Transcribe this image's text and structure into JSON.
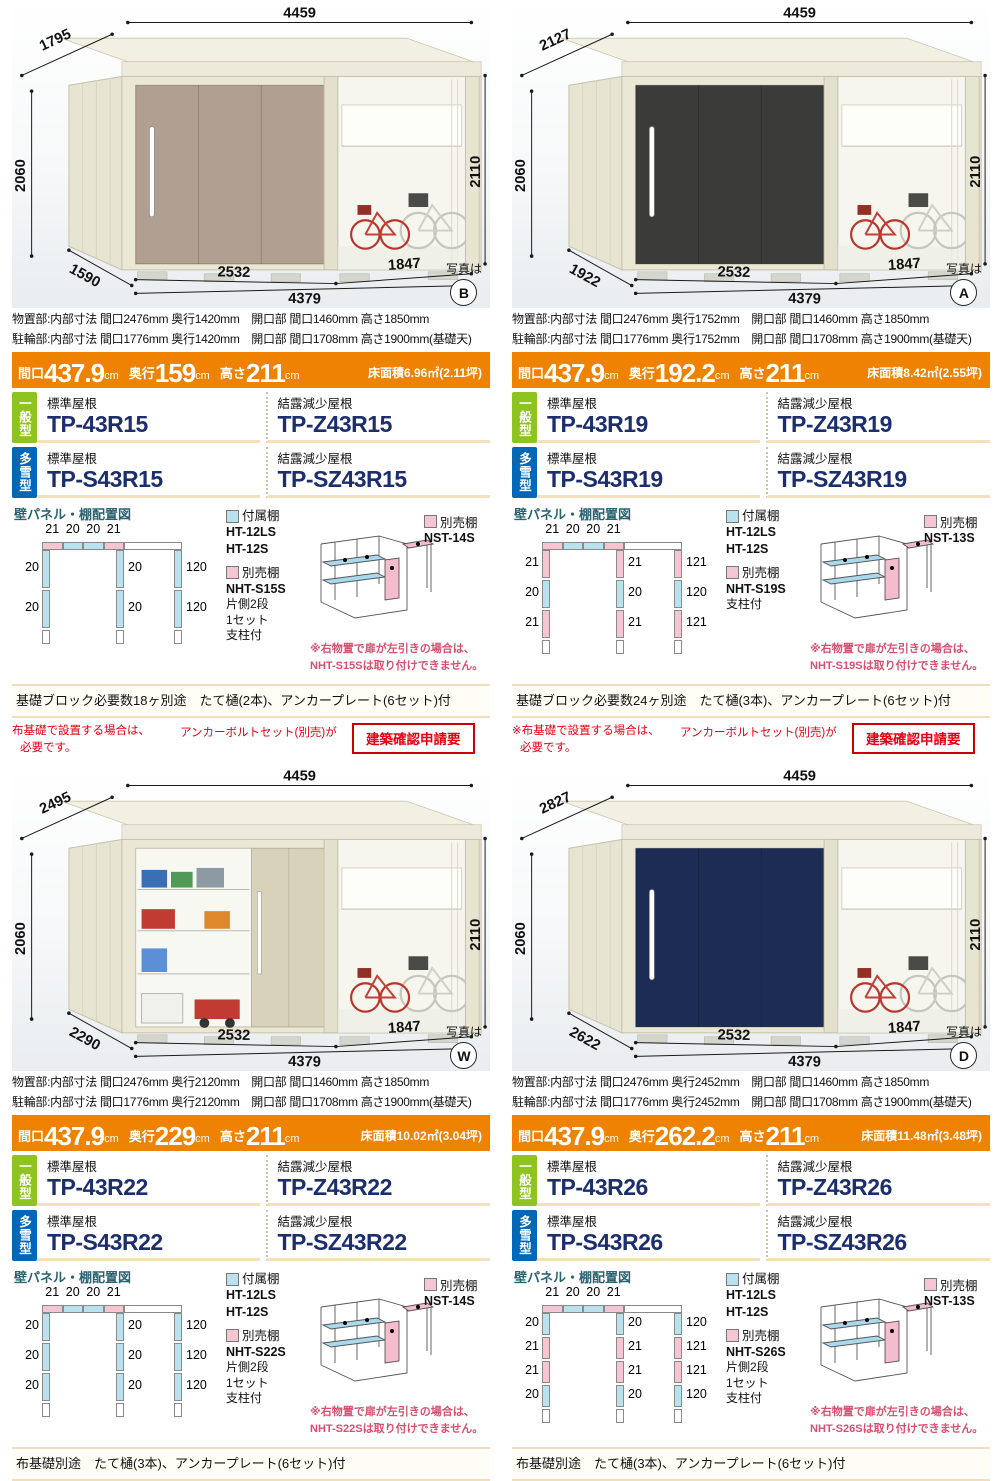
{
  "common": {
    "photo_label": "写真は",
    "panel_title": "壁パネル・棚配置図",
    "attached_label": "付属棚",
    "attached_models": [
      "HT-12LS",
      "HT-12S"
    ],
    "optional_label": "別売棚",
    "roof_standard": "標準屋根",
    "roof_dew": "結露減少屋根",
    "badge_general": "一般型",
    "badge_snow": "多雪型",
    "banner_labels": {
      "maguchi": "間口",
      "okuyuki": "奥行",
      "takasa": "高さ",
      "unit": "cm"
    },
    "panel_colors": {
      "blue": "#b9e1ee",
      "pink": "#f6c5d2"
    },
    "accent_orange": "#ef8200",
    "badge_green_color": "#8fc31f",
    "badge_blue_color": "#0068b7",
    "model_number_color": "#1c2e6e"
  },
  "products": [
    {
      "photo_letter": "B",
      "door_color": "#b1a091",
      "open": false,
      "notice": null,
      "dims": {
        "top_depth": "1795",
        "width": "4459",
        "left_h": "2060",
        "right_h": "2110",
        "storage_w": "2532",
        "bike_w": "1847",
        "total_w": "4379",
        "bottom_depth": "1590"
      },
      "specs": [
        "物置部:内部寸法 間口2476mm 奥行1420mm　開口部 間口1460mm 高さ1850mm",
        "駐輪部:内部寸法 間口1776mm 奥行1420mm　開口部 間口1708mm 高さ1900mm(基礎天)"
      ],
      "banner": {
        "maguchi": "437.9",
        "okuyuki": "159",
        "takasa": "211",
        "floor": "床面積6.96㎡(2.11坪)"
      },
      "models": {
        "g_std": "TP-43R15",
        "g_dew": "TP-Z43R15",
        "s_std": "TP-S43R15",
        "s_dew": "TP-SZ43R15"
      },
      "panel": {
        "top": [
          "21",
          "20",
          "20",
          "21"
        ],
        "left": [
          "20",
          "20"
        ],
        "mid": [
          "20",
          "20"
        ],
        "right": [
          "120",
          "120"
        ]
      },
      "optional1": "NST-14S",
      "optional2": [
        "NHT-S15S",
        "片側2段",
        "1セット",
        "支柱付"
      ],
      "warning": [
        "※右物置で扉が左引きの場合は、",
        "NHT-S15Sは取り付けできません。"
      ],
      "foundation": "基礎ブロック必要数18ヶ別途　たて樋(2本)、アンカープレート(6セット)付"
    },
    {
      "photo_letter": "A",
      "door_color": "#3b3b39",
      "open": false,
      "notice": null,
      "dims": {
        "top_depth": "2127",
        "width": "4459",
        "left_h": "2060",
        "right_h": "2110",
        "storage_w": "2532",
        "bike_w": "1847",
        "total_w": "4379",
        "bottom_depth": "1922"
      },
      "specs": [
        "物置部:内部寸法 間口2476mm 奥行1752mm　開口部 間口1460mm 高さ1850mm",
        "駐輪部:内部寸法 間口1776mm 奥行1752mm　開口部 間口1708mm 高さ1900mm(基礎天)"
      ],
      "banner": {
        "maguchi": "437.9",
        "okuyuki": "192.2",
        "takasa": "211",
        "floor": "床面積8.42㎡(2.55坪)"
      },
      "models": {
        "g_std": "TP-43R19",
        "g_dew": "TP-Z43R19",
        "s_std": "TP-S43R19",
        "s_dew": "TP-SZ43R19"
      },
      "panel": {
        "top": [
          "21",
          "20",
          "20",
          "21"
        ],
        "left": [
          "21",
          "20",
          "21"
        ],
        "mid": [
          "21",
          "20",
          "21"
        ],
        "right": [
          "121",
          "120",
          "121"
        ]
      },
      "optional1": "NST-13S",
      "optional2": [
        "NHT-S19S",
        "支柱付"
      ],
      "warning": [
        "※右物置で扉が左引きの場合は、",
        "NHT-S19Sは取り付けできません。"
      ],
      "foundation": "基礎ブロック必要数24ヶ別途　たて樋(3本)、アンカープレート(6セット)付"
    },
    {
      "photo_letter": "W",
      "door_color": "#d9d2ba",
      "open": true,
      "notice": {
        "line1": "布基礎で設置する場合は、",
        "line2": "必要です。",
        "mid": "アンカーボルトセット(別売)が",
        "boxed": "建築確認申請要"
      },
      "dims": {
        "top_depth": "2495",
        "width": "4459",
        "left_h": "2060",
        "right_h": "2110",
        "storage_w": "2532",
        "bike_w": "1847",
        "total_w": "4379",
        "bottom_depth": "2290"
      },
      "specs": [
        "物置部:内部寸法 間口2476mm 奥行2120mm　開口部 間口1460mm 高さ1850mm",
        "駐輪部:内部寸法 間口1776mm 奥行2120mm　開口部 間口1708mm 高さ1900mm(基礎天)"
      ],
      "banner": {
        "maguchi": "437.9",
        "okuyuki": "229",
        "takasa": "211",
        "floor": "床面積10.02㎡(3.04坪)"
      },
      "models": {
        "g_std": "TP-43R22",
        "g_dew": "TP-Z43R22",
        "s_std": "TP-S43R22",
        "s_dew": "TP-SZ43R22"
      },
      "panel": {
        "top": [
          "21",
          "20",
          "20",
          "21"
        ],
        "left": [
          "20",
          "20",
          "20"
        ],
        "mid": [
          "20",
          "20",
          "20"
        ],
        "right": [
          "120",
          "120",
          "120"
        ]
      },
      "optional1": "NST-14S",
      "optional2": [
        "NHT-S22S",
        "片側2段",
        "1セット",
        "支柱付"
      ],
      "warning": [
        "※右物置で扉が左引きの場合は、",
        "NHT-S22Sは取り付けできません。"
      ],
      "foundation": "布基礎別途　たて樋(3本)、アンカープレート(6セット)付"
    },
    {
      "photo_letter": "D",
      "door_color": "#1c2c55",
      "open": false,
      "notice": {
        "line1": "※布基礎で設置する場合は、",
        "line2": "必要です。",
        "mid": "アンカーボルトセット(別売)が",
        "boxed": "建築確認申請要"
      },
      "dims": {
        "top_depth": "2827",
        "width": "4459",
        "left_h": "2060",
        "right_h": "2110",
        "storage_w": "2532",
        "bike_w": "1847",
        "total_w": "4379",
        "bottom_depth": "2622"
      },
      "specs": [
        "物置部:内部寸法 間口2476mm 奥行2452mm　開口部 間口1460mm 高さ1850mm",
        "駐輪部:内部寸法 間口1776mm 奥行2452mm　開口部 間口1708mm 高さ1900mm(基礎天)"
      ],
      "banner": {
        "maguchi": "437.9",
        "okuyuki": "262.2",
        "takasa": "211",
        "floor": "床面積11.48㎡(3.48坪)"
      },
      "models": {
        "g_std": "TP-43R26",
        "g_dew": "TP-Z43R26",
        "s_std": "TP-S43R26",
        "s_dew": "TP-SZ43R26"
      },
      "panel": {
        "top": [
          "21",
          "20",
          "20",
          "21"
        ],
        "left": [
          "20",
          "21",
          "21",
          "20"
        ],
        "mid": [
          "20",
          "21",
          "21",
          "20"
        ],
        "right": [
          "120",
          "121",
          "121",
          "120"
        ]
      },
      "optional1": "NST-13S",
      "optional2": [
        "NHT-S26S",
        "片側2段",
        "1セット",
        "支柱付"
      ],
      "warning": [
        "※右物置で扉が左引きの場合は、",
        "NHT-S26Sは取り付けできません。"
      ],
      "foundation": "布基礎別途　たて樋(3本)、アンカープレート(6セット)付"
    }
  ]
}
